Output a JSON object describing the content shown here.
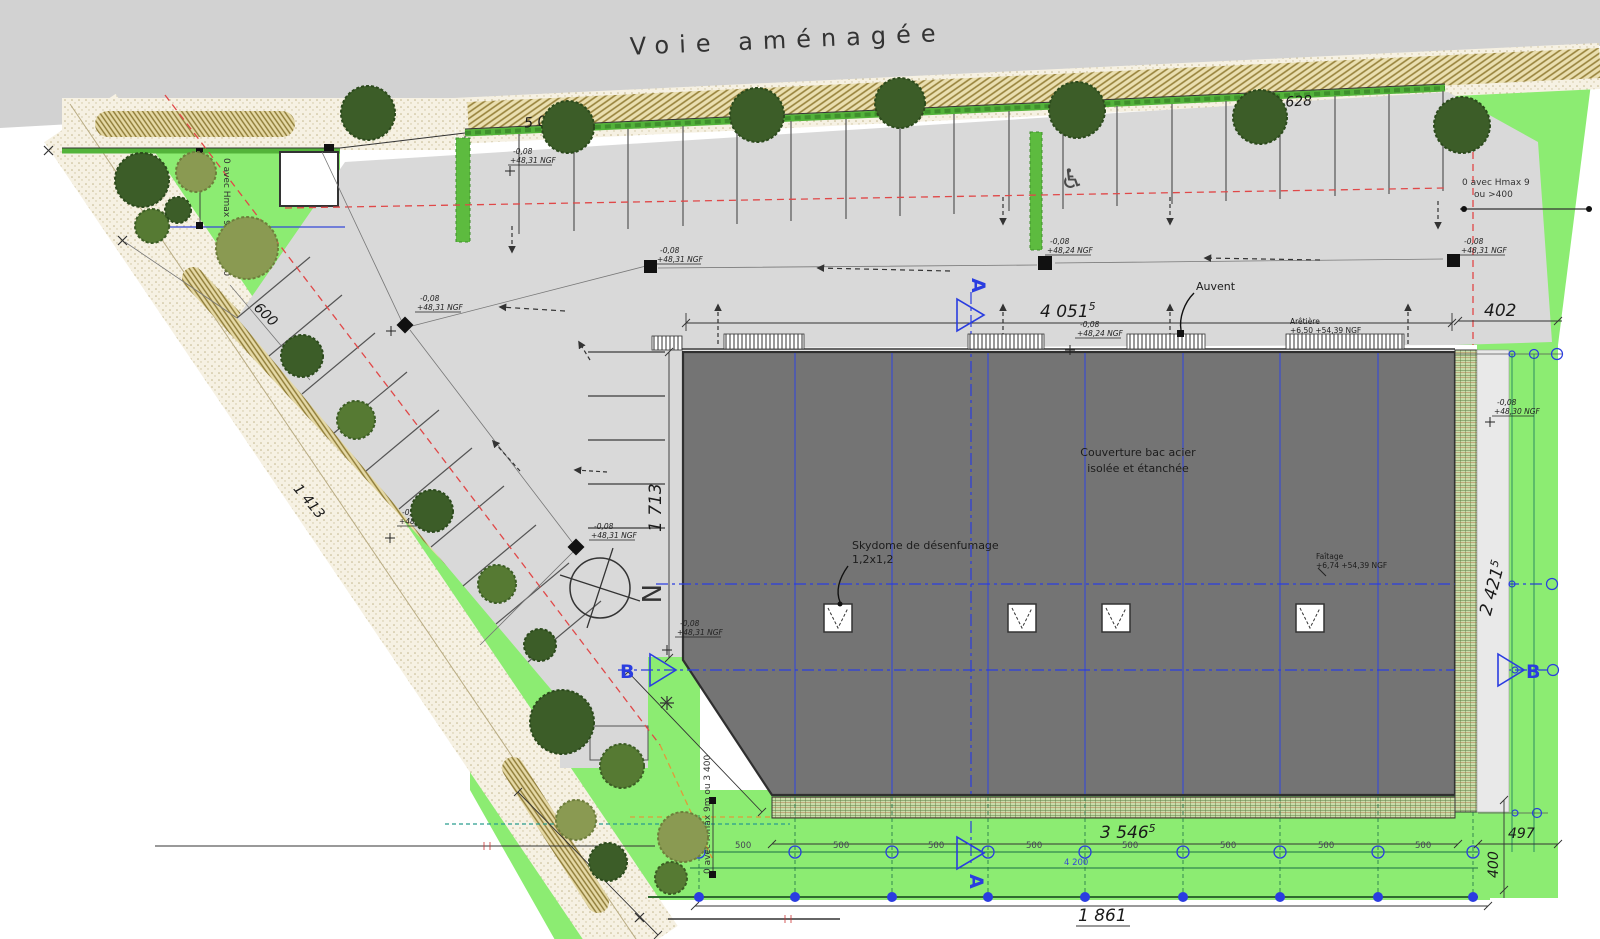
{
  "title": "Voie aménagée",
  "colors": {
    "accent_blue": "#2a3de0",
    "grid_teal": "#1d6e46",
    "limit_red": "#e04848",
    "lawn_green": "#8cec72",
    "roof_gray": "#747474"
  },
  "building": {
    "couverture_l1": "Couverture bac acier",
    "couverture_l2": "isolée et étanchée",
    "skydome_l1": "Skydome de désenfumage",
    "skydome_l2": "1,2x1,2",
    "auvent": "Auvent",
    "aretiere": "Arêtière",
    "aretiere_level": "+6,50  +54,39 NGF",
    "faitage": "Faîtage",
    "faitage_level": "+6,74  +54,39 NGF"
  },
  "symbols": {
    "north": "N",
    "section_a": "A",
    "section_b": "B",
    "handicap": "♿"
  },
  "dimensions": {
    "top_left": "5 028",
    "top_right": "2 628",
    "left_offset": "600",
    "left_diag": "1 413",
    "bldg_top": "4 051",
    "bldg_top_sup": "5",
    "right_gap": "402",
    "bldg_left": "1 713",
    "right_diag": "2 421",
    "right_diag_sup": "5",
    "bldg_bottom": "3 546",
    "bldg_bottom_sup": "5",
    "gap_497": "497",
    "gap_400": "400",
    "total_bottom": "1 861",
    "sub_bottom": "4 200",
    "bay_1": "500",
    "bay_2": "500",
    "bay_3": "500",
    "bay_4": "500",
    "bay_5": "500",
    "bay_6": "500",
    "bay_7": "500",
    "bay_8": "500"
  },
  "notes": {
    "hmax_left": "0 avec Hmax 9m ou >400",
    "hmax_right_l1": "0 avec Hmax 9",
    "hmax_right_l2": "ou >400",
    "hmax_bottom": "0 avec Hmax 9m ou 3 400"
  },
  "levels": [
    {
      "a": "-0,08",
      "b": "+48,31 NGF"
    },
    {
      "a": "-0,08",
      "b": "+48,24 NGF"
    },
    {
      "a": "-0,08",
      "b": "+48,31 NGF"
    },
    {
      "a": "-0,08",
      "b": "+48,31 NGF"
    },
    {
      "a": "-0,08",
      "b": "+48,20 NGF"
    },
    {
      "a": "-0,08",
      "b": "+48,31 NGF"
    },
    {
      "a": "-0,08",
      "b": "+48,31 NGF"
    },
    {
      "a": "-0,08",
      "b": "+48,24 NGF"
    },
    {
      "a": "-0,08",
      "b": "+48,31 NGF"
    },
    {
      "a": "-0,08",
      "b": "+48,30 NGF"
    }
  ]
}
